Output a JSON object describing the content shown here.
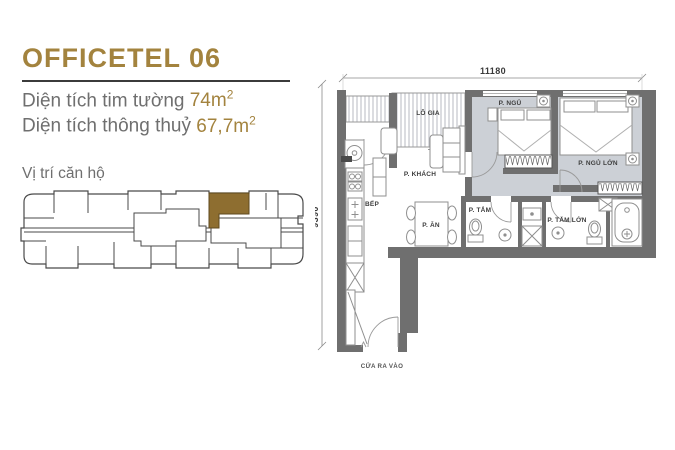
{
  "colors": {
    "accent_gold": "#a3833e",
    "text_gray": "#6f6f6f",
    "underline": "#3b3b3b",
    "wall": "#6f6f6f",
    "floor_gray": "#ccd0d6",
    "unit_highlight": "#8e6e30"
  },
  "header": {
    "title": "OFFICETEL 06",
    "area_lines": [
      {
        "label": "Diện tích tim tường ",
        "value": "74m",
        "sup": "2"
      },
      {
        "label": "Diện tích thông thuỷ ",
        "value": "67,7m",
        "sup": "2"
      }
    ],
    "location_label": "Vị trí căn hộ"
  },
  "floor_plan": {
    "dim_width": "11180",
    "dim_height": "9390",
    "rooms": {
      "balcony": "LÔ GIA",
      "living": "P. KHÁCH",
      "bedroom": "P. NGỦ",
      "master_bedroom": "P. NGỦ LỚN",
      "kitchen": "BẾP",
      "dining": "P. ĂN",
      "bathroom": "P. TẮM",
      "master_bathroom": "P. TẮM LỚN",
      "entrance": "CỬA RA VÀO"
    }
  }
}
